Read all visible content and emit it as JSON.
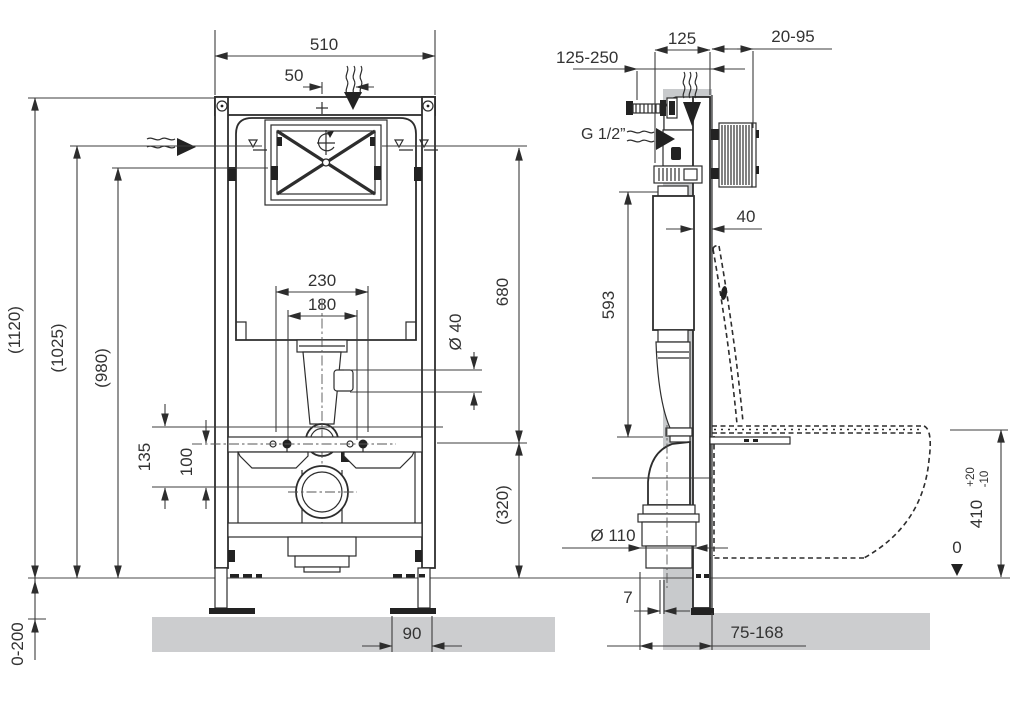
{
  "drawing": {
    "colors": {
      "wall": "#c8cacc",
      "slab": "#cccdcf",
      "line": "#2d2d2d"
    },
    "front_view": {
      "dims": {
        "width_510": "510",
        "offset_50": "50",
        "height_1120": "(1120)",
        "height_1025": "(1025)",
        "height_980": "(980)",
        "floor_adjust": "0-200",
        "stud_230": "230",
        "stud_180": "180",
        "pipe_dia": "Ø 40",
        "height_680": "680",
        "height_320": "(320)",
        "height_135": "135",
        "height_100": "100",
        "foot_90": "90"
      }
    },
    "side_view": {
      "dims": {
        "anchor_range": "125-250",
        "depth_125": "125",
        "finish_range": "20-95",
        "inlet_thread": "G 1/2”",
        "gap_40": "40",
        "height_593": "593",
        "drain_dia": "Ø 110",
        "seat_height": "410",
        "tol_plus": "+20",
        "tol_minus": "-10",
        "floor_zero": "0",
        "offset_7": "7",
        "drain_range": "75-168"
      }
    }
  }
}
